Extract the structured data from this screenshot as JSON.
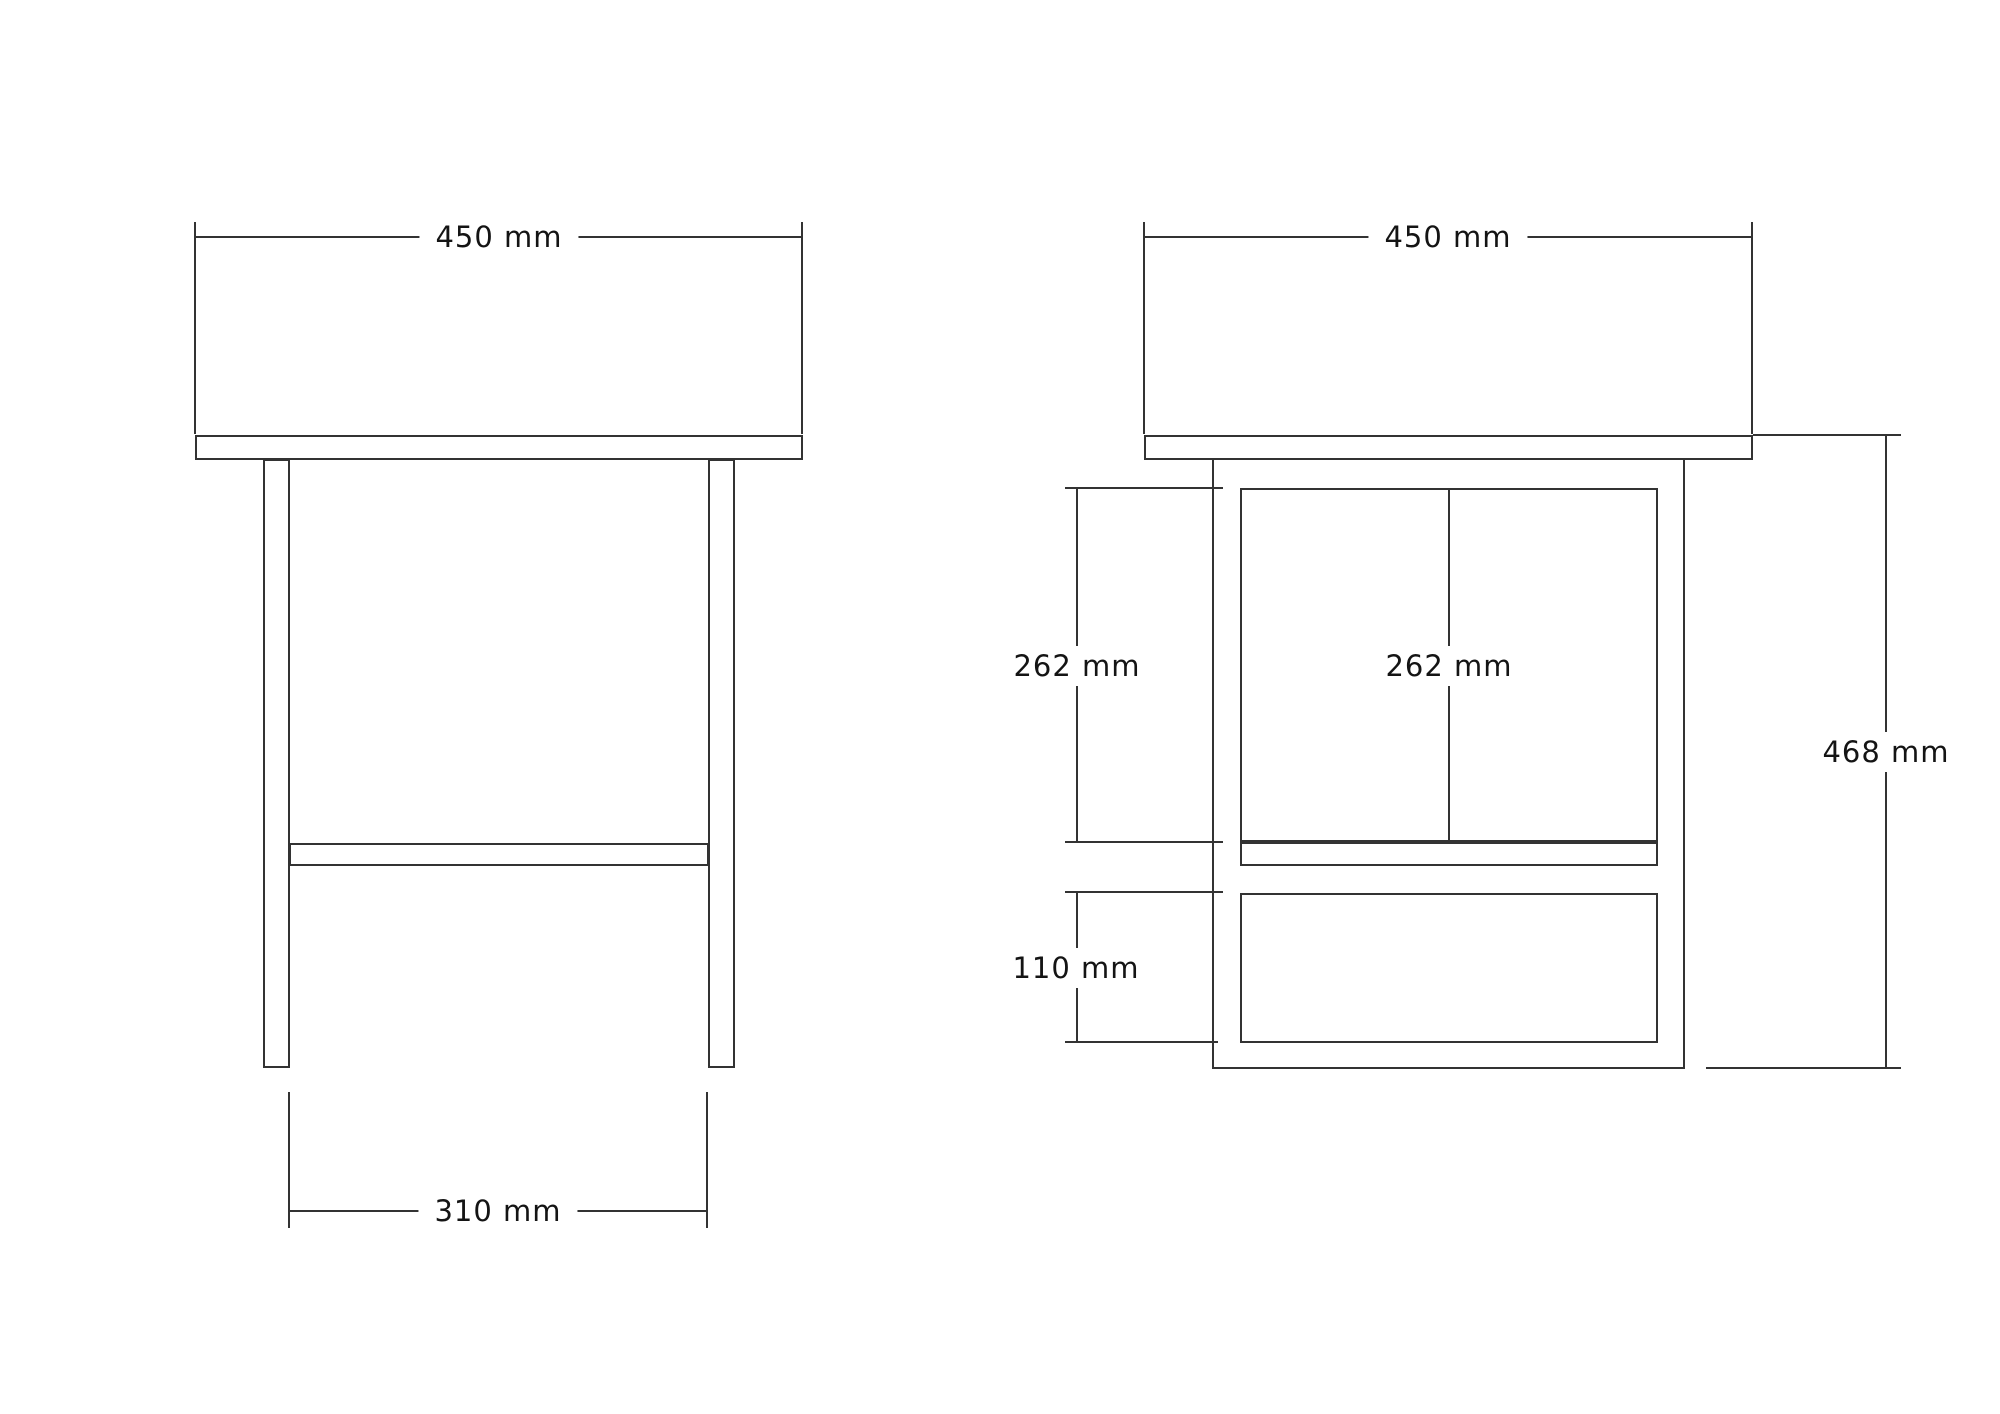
{
  "side_view": {
    "labels": {
      "top_width": "450 mm",
      "leg_inner_span": "310 mm"
    }
  },
  "front_view": {
    "labels": {
      "top_width": "450 mm",
      "door_height": "262 mm",
      "door_center": "262 mm",
      "drawer_height": "110 mm",
      "overall_height": "468 mm"
    }
  },
  "colors": {
    "line": "#333333",
    "text": "#141414",
    "background": "#ffffff"
  }
}
